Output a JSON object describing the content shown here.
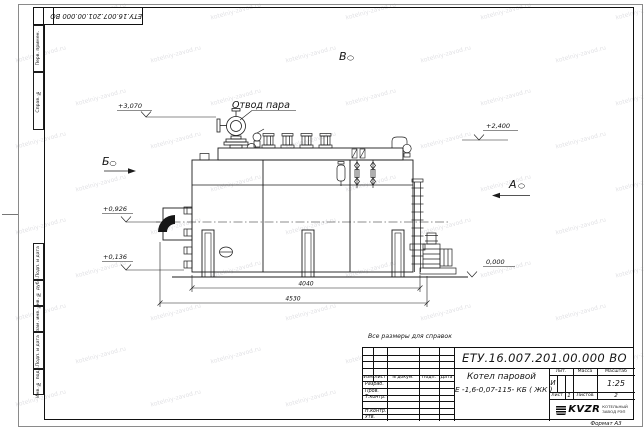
{
  "sheet": {
    "corner_doc_number": "ЕТУ.16.007.201.00.000  ВО",
    "format_label": "Формат А3",
    "reference_note": "Все размеры для справок"
  },
  "margin_fields": {
    "top": [
      "Перв. примен.",
      "Справ. №"
    ],
    "bottom": [
      "Подп. и дата",
      "Инв. № дубл.",
      "Взам. инв. №",
      "Подп. и дата",
      "Инв. № подл."
    ]
  },
  "title_block": {
    "doc_number": "ЕТУ.16.007.201.00.000  ВО",
    "product_name": "Котел паровой",
    "product_model": "Е -1,6-0,07-115- КБ ( ЖК )",
    "col_izm": "Изм",
    "col_list": "Лист",
    "col_ndokum": "N докум.",
    "col_podp": "Подп.",
    "col_data": "Дата",
    "row_labels": [
      "Разраб.",
      "Пров.",
      "Т.контр.",
      "",
      "Н.контр.",
      "Утв."
    ],
    "lit_label": "Лит.",
    "lit_value": "И",
    "massa_label": "Масса",
    "masshtab_label": "Масштаб",
    "scale_value": "1:25",
    "sheet_label": "Лист",
    "sheet_value": "1",
    "sheets_label": "Листов",
    "sheets_value": "2",
    "logo_text": "KVZR",
    "company_line1": "КОТЕЛЬНЫЙ",
    "company_line2": "ЗАВОД РЭП"
  },
  "drawing": {
    "steam_outlet_label": "Отвод пара",
    "view_a": "А",
    "view_b": "Б",
    "view_v": "В",
    "elevations": {
      "top_left": "+3,070",
      "top_right": "+2,400",
      "mid_left": "+0,926",
      "low_left": "+0,136",
      "zero": "0,000"
    },
    "dimensions": {
      "inner": "4040",
      "overall": "4530"
    }
  },
  "watermark": {
    "text": "kotelniy-zavod.ru"
  }
}
